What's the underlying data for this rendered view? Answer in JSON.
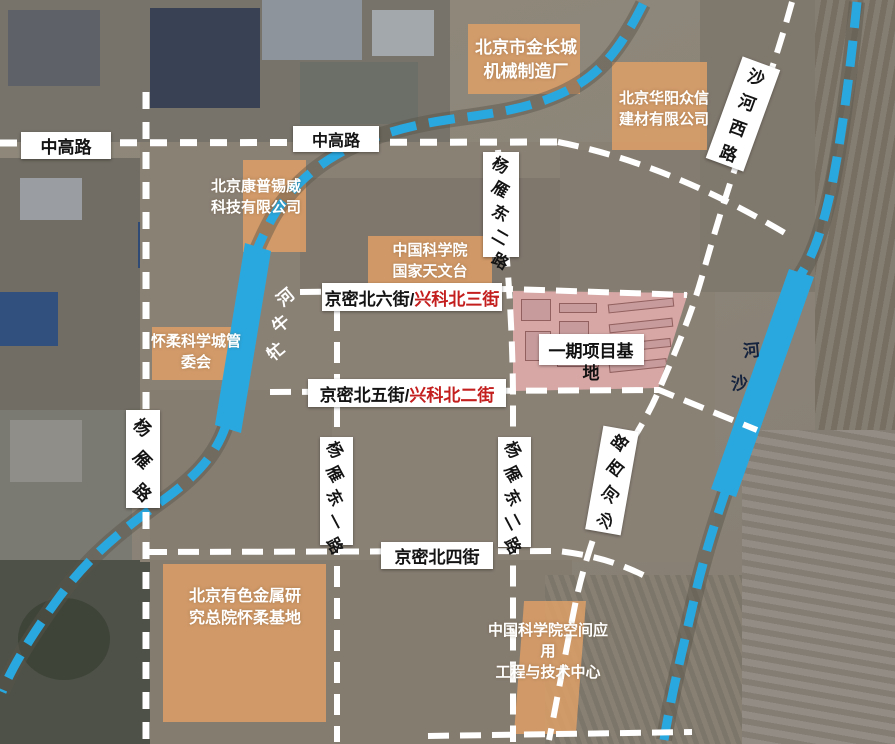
{
  "colors": {
    "river_blue": "#29a8e0",
    "highlight_orange": "#e2a066",
    "parcel_pink": "#d9a6a6",
    "road_white": "#ffffff",
    "street_red": "#c41f1f",
    "label_text": "#141414"
  },
  "map": {
    "roads": {
      "zhonggao_left": {
        "label": "中高路"
      },
      "zhonggao_center": {
        "label": "中高路"
      },
      "shahexilu_top": {
        "label": "沙河西路"
      },
      "shahexilu_mid": {
        "label": "沙河西路"
      },
      "yangyanlu": {
        "label": "杨雁路"
      },
      "yangyan_dong1": {
        "label": "杨雁东一路"
      },
      "yangyan_dong2_upper": {
        "label": "杨雁东二路"
      },
      "yangyan_dong2_lower": {
        "label": "杨雁东二路"
      },
      "jingmi_bei6": {
        "name": "京密北六街/",
        "alt_name": "兴科北三街"
      },
      "jingmi_bei5": {
        "name": "京密北五街/",
        "alt_name": "兴科北二街"
      },
      "jingmi_bei4": {
        "label": "京密北四街"
      }
    },
    "rivers": {
      "mangniu": {
        "label": "牤牛河"
      },
      "shahe": {
        "label": "沙河"
      }
    },
    "sites": {
      "jinchangcheng": {
        "text": "北京市金长城\n机械制造厂"
      },
      "huayang": {
        "text": "北京华阳众信\n建材有限公司"
      },
      "kangpu": {
        "text": "北京康普锡威\n科技有限公司"
      },
      "tianwentai": {
        "text": "中国科学院\n国家天文台"
      },
      "guanweihui": {
        "text": "怀柔科学城管\n委会"
      },
      "youse": {
        "text": "北京有色金属研\n究总院怀柔基地"
      },
      "kongjian": {
        "text": "中国科学院空间应\n用\n工程与技术中心"
      },
      "phase1": {
        "line1": "一期项目基",
        "line2": "地"
      }
    }
  }
}
